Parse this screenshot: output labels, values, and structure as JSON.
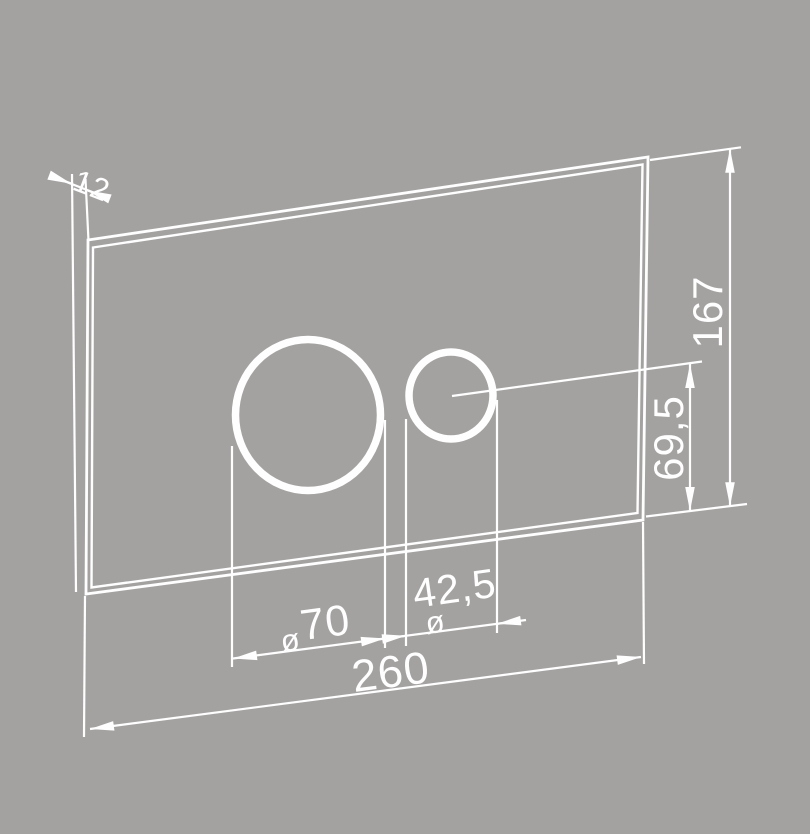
{
  "colors": {
    "background": "#a4a2a1",
    "line": "#fefefe"
  },
  "drawing": {
    "labels": {
      "thickness": "12",
      "height": "167",
      "button_center_height": "69,5",
      "width": "260",
      "large_hole_symbol": "ø",
      "large_hole_value": "70",
      "small_hole_value": "42,5",
      "small_hole_symbol": "ø"
    }
  }
}
